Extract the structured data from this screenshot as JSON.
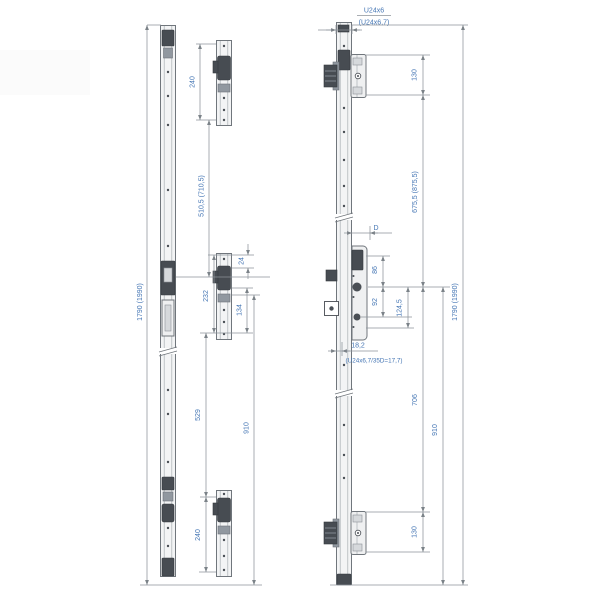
{
  "drawing": {
    "profile_label": "U24x6",
    "profile_label_alt": "(U24x6,7)",
    "profile_note": "(U24x6,7/35D=17,7)",
    "left": {
      "overall": "1790 (1990)",
      "ext_top": "240",
      "top_to_center": "510,5 (710,5)",
      "mid_top_offset": "24",
      "mid_length": "232",
      "mid_lower": "134",
      "center_to_lower": "529",
      "mid_to_bottom": "910",
      "ext_bottom": "240"
    },
    "right": {
      "overall": "1790 (1990)",
      "keeper_top": "130",
      "top_span": "675,5 (875,5)",
      "backset": "D",
      "dim_86": "86",
      "dim_92": "92",
      "dim_124": "124,5",
      "dim_182": "18,2",
      "bottom_span": "706",
      "center_to_bottom": "910",
      "keeper_bottom": "130"
    },
    "colors": {
      "dimension_text": "#4576b4",
      "part_line": "#70767c",
      "part_dark": "#474c52",
      "dim_line": "#8d939a",
      "background": "#ffffff"
    }
  }
}
